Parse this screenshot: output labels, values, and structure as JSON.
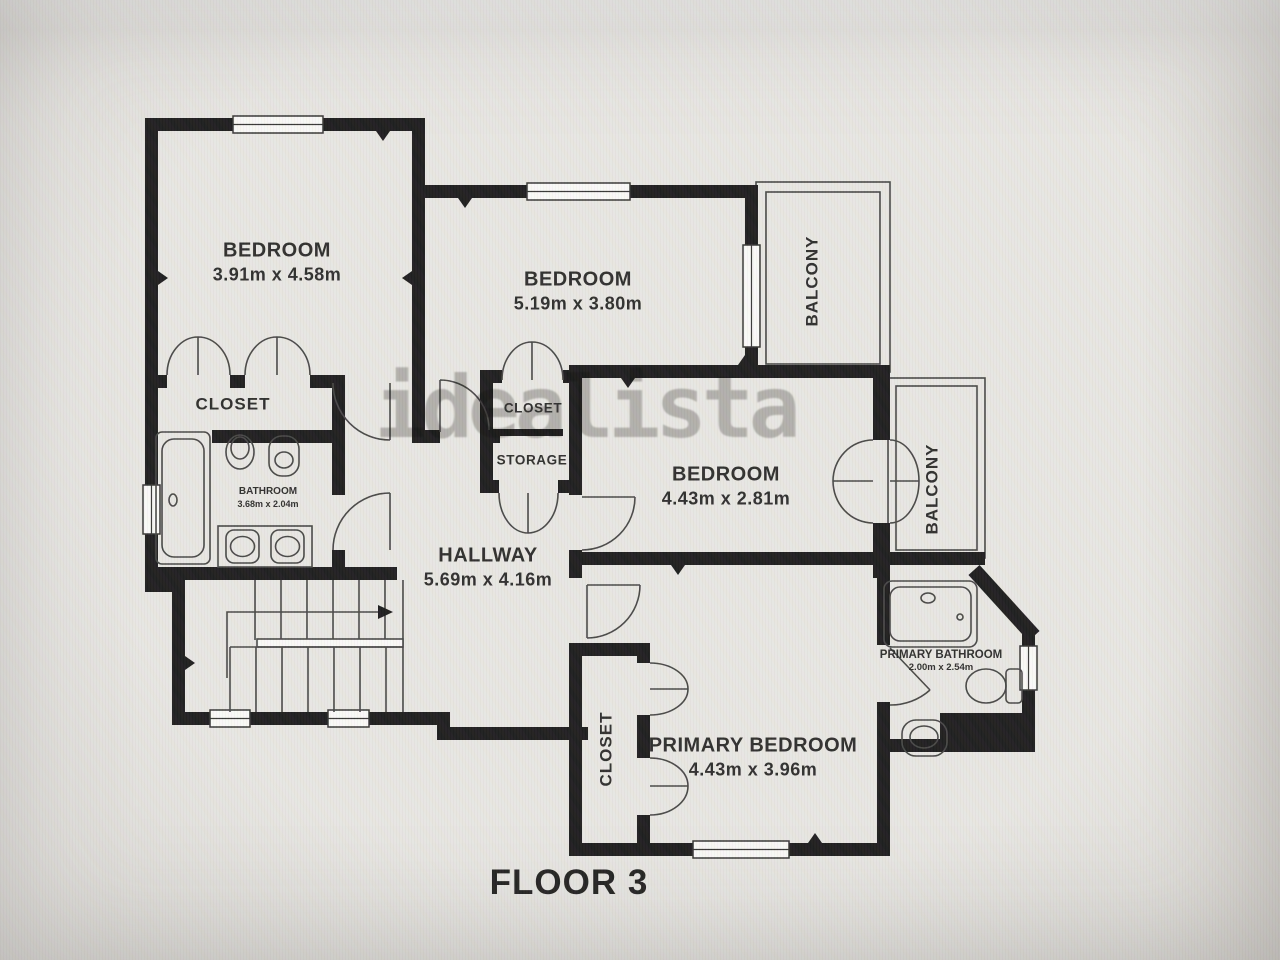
{
  "floor_label": "FLOOR 3",
  "watermark": "idealista",
  "rooms": {
    "bedroom1": {
      "label": "BEDROOM",
      "dims": "3.91m x 4.58m"
    },
    "bedroom2": {
      "label": "BEDROOM",
      "dims": "5.19m x 3.80m"
    },
    "bedroom3": {
      "label": "BEDROOM",
      "dims": "4.43m x 2.81m"
    },
    "primary_bedroom": {
      "label": "PRIMARY BEDROOM",
      "dims": "4.43m x 3.96m"
    },
    "hallway": {
      "label": "HALLWAY",
      "dims": "5.69m x 4.16m"
    },
    "bathroom": {
      "label": "BATHROOM",
      "dims": "3.68m x 2.04m"
    },
    "primary_bathroom": {
      "label": "PRIMARY BATHROOM",
      "dims": "2.00m x 2.54m"
    },
    "closet_bedroom1": {
      "label": "CLOSET"
    },
    "closet_mid": {
      "label": "CLOSET"
    },
    "storage": {
      "label": "STORAGE"
    },
    "closet_primary": {
      "label": "CLOSET"
    },
    "balcony_top": {
      "label": "BALCONY"
    },
    "balcony_right": {
      "label": "BALCONY"
    }
  },
  "colors": {
    "wall": "#1a1a1c",
    "line": "#454545",
    "text": "#2b2b2b",
    "bg": "#e9e8e5",
    "watermark": "#8f8e8b"
  }
}
